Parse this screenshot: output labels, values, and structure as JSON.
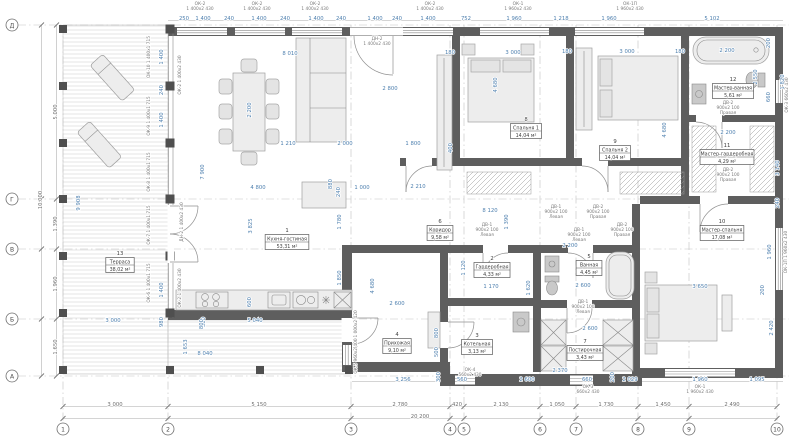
{
  "drawing": {
    "type": "architectural-floor-plan",
    "units": "mm",
    "accent_dim_color": "#4d7fae",
    "wall_color": "#5e5e5e",
    "grid": {
      "cols": [
        {
          "label": "1",
          "x": 63
        },
        {
          "label": "2",
          "x": 168
        },
        {
          "label": "3",
          "x": 351
        },
        {
          "label": "4",
          "x": 450
        },
        {
          "label": "5",
          "x": 464
        },
        {
          "label": "6",
          "x": 540
        },
        {
          "label": "7",
          "x": 576
        },
        {
          "label": "8",
          "x": 638
        },
        {
          "label": "9",
          "x": 689
        },
        {
          "label": "10",
          "x": 777
        }
      ],
      "rows": [
        {
          "label": "Д",
          "y": 25
        },
        {
          "label": "Г",
          "y": 199
        },
        {
          "label": "В",
          "y": 249
        },
        {
          "label": "Б",
          "y": 319
        },
        {
          "label": "А",
          "y": 376
        }
      ]
    },
    "rooms": [
      {
        "num": "1",
        "name": "Кухня-гостиная",
        "area": "53,31 м²",
        "x": 287,
        "y": 240
      },
      {
        "num": "2",
        "name": "Гардеробная",
        "area": "4,33 м²",
        "x": 492,
        "y": 268
      },
      {
        "num": "3",
        "name": "Котельная",
        "area": "3,13 м²",
        "x": 477,
        "y": 345
      },
      {
        "num": "4",
        "name": "Прихожая",
        "area": "9,10 м²",
        "x": 397,
        "y": 344
      },
      {
        "num": "5",
        "name": "Ванная",
        "area": "4,45 м²",
        "x": 589,
        "y": 266
      },
      {
        "num": "6",
        "name": "Коридор",
        "area": "9,58 м²",
        "x": 440,
        "y": 231
      },
      {
        "num": "7",
        "name": "Постирочная",
        "area": "3,43 м²",
        "x": 585,
        "y": 351
      },
      {
        "num": "8",
        "name": "Спальня 1",
        "area": "14,04 м²",
        "x": 526,
        "y": 129
      },
      {
        "num": "9",
        "name": "Спальня 2",
        "area": "14,04 м²",
        "x": 615,
        "y": 151
      },
      {
        "num": "10",
        "name": "Мастер-спальня",
        "area": "17,08 м²",
        "x": 722,
        "y": 231
      },
      {
        "num": "11",
        "name": "Мастер-гардеробная",
        "area": "4,29 м²",
        "x": 727,
        "y": 155
      },
      {
        "num": "12",
        "name": "Мастер-ванная",
        "area": "5,61 м²",
        "x": 733,
        "y": 89
      },
      {
        "num": "13",
        "name": "Терраса",
        "area": "38,02 м²",
        "x": 120,
        "y": 263
      }
    ],
    "dims": [
      {
        "t": "250",
        "x": 184,
        "y": 20
      },
      {
        "t": "1 400",
        "x": 203,
        "y": 20
      },
      {
        "t": "240",
        "x": 229,
        "y": 20
      },
      {
        "t": "1 400",
        "x": 259,
        "y": 20
      },
      {
        "t": "240",
        "x": 285,
        "y": 20
      },
      {
        "t": "1 400",
        "x": 316,
        "y": 20
      },
      {
        "t": "240",
        "x": 341,
        "y": 20
      },
      {
        "t": "1 400",
        "x": 375,
        "y": 20
      },
      {
        "t": "240",
        "x": 397,
        "y": 20
      },
      {
        "t": "1 400",
        "x": 428,
        "y": 20
      },
      {
        "t": "752",
        "x": 466,
        "y": 20
      },
      {
        "t": "1 960",
        "x": 514,
        "y": 20
      },
      {
        "t": "1 218",
        "x": 561,
        "y": 20
      },
      {
        "t": "1 960",
        "x": 609,
        "y": 20
      },
      {
        "t": "5 102",
        "x": 712,
        "y": 20
      },
      {
        "t": "5 000",
        "x": 57,
        "y": 112,
        "r": 1,
        "c": "g"
      },
      {
        "t": "1 390",
        "x": 57,
        "y": 224,
        "r": 1,
        "c": "g"
      },
      {
        "t": "1 960",
        "x": 57,
        "y": 284,
        "r": 1,
        "c": "g"
      },
      {
        "t": "1 650",
        "x": 57,
        "y": 347,
        "r": 1,
        "c": "g"
      },
      {
        "t": "10 000",
        "x": 42,
        "y": 200,
        "r": 1,
        "c": "g"
      },
      {
        "t": "3 000",
        "x": 115,
        "y": 406,
        "c": "g"
      },
      {
        "t": "5 150",
        "x": 259,
        "y": 406,
        "c": "g"
      },
      {
        "t": "2 780",
        "x": 400,
        "y": 406,
        "c": "g"
      },
      {
        "t": "420",
        "x": 457,
        "y": 406,
        "c": "g"
      },
      {
        "t": "2 130",
        "x": 501,
        "y": 406,
        "c": "g"
      },
      {
        "t": "1 050",
        "x": 557,
        "y": 406,
        "c": "g"
      },
      {
        "t": "1 730",
        "x": 606,
        "y": 406,
        "c": "g"
      },
      {
        "t": "1 450",
        "x": 663,
        "y": 406,
        "c": "g"
      },
      {
        "t": "2 490",
        "x": 732,
        "y": 406,
        "c": "g"
      },
      {
        "t": "20 200",
        "x": 420,
        "y": 418,
        "c": "g"
      },
      {
        "t": "3 256",
        "x": 403,
        "y": 381
      },
      {
        "t": "300",
        "x": 440,
        "y": 377,
        "r": 1
      },
      {
        "t": "560",
        "x": 462,
        "y": 381
      },
      {
        "t": "2 600",
        "x": 527,
        "y": 381
      },
      {
        "t": "2 370",
        "x": 560,
        "y": 372
      },
      {
        "t": "660",
        "x": 587,
        "y": 381
      },
      {
        "t": "2 029",
        "x": 630,
        "y": 381
      },
      {
        "t": "1 960",
        "x": 700,
        "y": 381
      },
      {
        "t": "1 095",
        "x": 757,
        "y": 381
      },
      {
        "t": "200",
        "x": 614,
        "y": 377,
        "r": 1
      },
      {
        "t": "9 908",
        "x": 80,
        "y": 203,
        "r": 1
      },
      {
        "t": "3 000",
        "x": 113,
        "y": 322
      },
      {
        "t": "980",
        "x": 163,
        "y": 322,
        "r": 1
      },
      {
        "t": "300",
        "x": 205,
        "y": 322,
        "r": 1
      },
      {
        "t": "5 040",
        "x": 255,
        "y": 322
      },
      {
        "t": "600",
        "x": 251,
        "y": 302,
        "r": 1
      },
      {
        "t": "8 040",
        "x": 205,
        "y": 355
      },
      {
        "t": "1 653",
        "x": 187,
        "y": 347,
        "r": 1
      },
      {
        "t": "8 010",
        "x": 290,
        "y": 55
      },
      {
        "t": "2 800",
        "x": 390,
        "y": 90
      },
      {
        "t": "2 200",
        "x": 251,
        "y": 110,
        "r": 1
      },
      {
        "t": "1 210",
        "x": 288,
        "y": 145
      },
      {
        "t": "2 000",
        "x": 345,
        "y": 145
      },
      {
        "t": "1 800",
        "x": 413,
        "y": 145
      },
      {
        "t": "7 900",
        "x": 204,
        "y": 172,
        "r": 1
      },
      {
        "t": "4 800",
        "x": 258,
        "y": 189
      },
      {
        "t": "1 000",
        "x": 362,
        "y": 189
      },
      {
        "t": "880",
        "x": 332,
        "y": 184,
        "r": 1
      },
      {
        "t": "240",
        "x": 340,
        "y": 192,
        "r": 1
      },
      {
        "t": "3 825",
        "x": 252,
        "y": 226,
        "r": 1
      },
      {
        "t": "1 780",
        "x": 341,
        "y": 222,
        "r": 1
      },
      {
        "t": "1 850",
        "x": 341,
        "y": 278,
        "r": 1
      },
      {
        "t": "4 680",
        "x": 374,
        "y": 286,
        "r": 1
      },
      {
        "t": "800",
        "x": 203,
        "y": 324,
        "r": 1
      },
      {
        "t": "2 210",
        "x": 418,
        "y": 188
      },
      {
        "t": "1 400",
        "x": 163,
        "y": 57,
        "r": 1
      },
      {
        "t": "240",
        "x": 163,
        "y": 90,
        "r": 1
      },
      {
        "t": "1 400",
        "x": 163,
        "y": 120,
        "r": 1
      },
      {
        "t": "1 400",
        "x": 163,
        "y": 290,
        "r": 1
      },
      {
        "t": "180",
        "x": 450,
        "y": 54
      },
      {
        "t": "3 000",
        "x": 513,
        "y": 54
      },
      {
        "t": "4 680",
        "x": 497,
        "y": 85,
        "r": 1
      },
      {
        "t": "400",
        "x": 452,
        "y": 148,
        "r": 1
      },
      {
        "t": "180",
        "x": 567,
        "y": 53
      },
      {
        "t": "3 000",
        "x": 627,
        "y": 53
      },
      {
        "t": "180",
        "x": 680,
        "y": 53
      },
      {
        "t": "4 680",
        "x": 666,
        "y": 130,
        "r": 1
      },
      {
        "t": "8 120",
        "x": 490,
        "y": 212
      },
      {
        "t": "1 390",
        "x": 508,
        "y": 222,
        "r": 1
      },
      {
        "t": "1 120",
        "x": 465,
        "y": 268,
        "r": 1
      },
      {
        "t": "1 170",
        "x": 491,
        "y": 288
      },
      {
        "t": "1 620",
        "x": 530,
        "y": 288,
        "r": 1
      },
      {
        "t": "2 600",
        "x": 397,
        "y": 305
      },
      {
        "t": "800",
        "x": 438,
        "y": 333,
        "r": 1
      },
      {
        "t": "500",
        "x": 438,
        "y": 352,
        "r": 1
      },
      {
        "t": "2 600",
        "x": 583,
        "y": 287
      },
      {
        "t": "2 600",
        "x": 590,
        "y": 330
      },
      {
        "t": "2 200",
        "x": 570,
        "y": 247
      },
      {
        "t": "2 200",
        "x": 727,
        "y": 52
      },
      {
        "t": "200",
        "x": 770,
        "y": 43,
        "r": 1
      },
      {
        "t": "2 550",
        "x": 757,
        "y": 77,
        "r": 1
      },
      {
        "t": "660",
        "x": 770,
        "y": 97,
        "r": 1
      },
      {
        "t": "1 820",
        "x": 784,
        "y": 82,
        "r": 1
      },
      {
        "t": "2 200",
        "x": 728,
        "y": 134
      },
      {
        "t": "1 950",
        "x": 751,
        "y": 157,
        "r": 1
      },
      {
        "t": "3 140",
        "x": 779,
        "y": 168,
        "r": 1
      },
      {
        "t": "240",
        "x": 779,
        "y": 203,
        "r": 1
      },
      {
        "t": "1 960",
        "x": 771,
        "y": 252,
        "r": 1
      },
      {
        "t": "3 650",
        "x": 700,
        "y": 288
      },
      {
        "t": "200",
        "x": 764,
        "y": 290,
        "r": 1
      },
      {
        "t": "2 420",
        "x": 773,
        "y": 328,
        "r": 1
      }
    ],
    "tags": [
      {
        "x": 200,
        "y": 5,
        "lines": [
          "ОК-2",
          "1 400х2 430"
        ]
      },
      {
        "x": 257,
        "y": 5,
        "lines": [
          "ОК-2",
          "1 400х2 430"
        ]
      },
      {
        "x": 315,
        "y": 5,
        "lines": [
          "ОК-2",
          "1 400х2 430"
        ]
      },
      {
        "x": 430,
        "y": 5,
        "lines": [
          "ОК-2",
          "1 400х2 430"
        ]
      },
      {
        "x": 518,
        "y": 5,
        "lines": [
          "ОК-1",
          "1 960х2 430"
        ]
      },
      {
        "x": 630,
        "y": 5,
        "lines": [
          "ОК-1П",
          "1 960х2 430"
        ]
      },
      {
        "x": 377,
        "y": 40,
        "lines": [
          "ДН-2",
          "1 400х2 430"
        ]
      },
      {
        "x": 487,
        "y": 226,
        "lines": [
          "ДВ-1",
          "900х2 100",
          "Левая"
        ]
      },
      {
        "x": 556,
        "y": 208,
        "lines": [
          "ДВ-1",
          "900х2 100",
          "Левая"
        ]
      },
      {
        "x": 598,
        "y": 208,
        "lines": [
          "ДВ-2",
          "900х2 100",
          "Правая"
        ]
      },
      {
        "x": 579,
        "y": 231,
        "lines": [
          "ДВ-1",
          "900х2 100",
          "Левая"
        ]
      },
      {
        "x": 622,
        "y": 226,
        "lines": [
          "ДВ-2",
          "900х2 100",
          "Правая"
        ]
      },
      {
        "x": 583,
        "y": 303,
        "lines": [
          "ДВ-1",
          "900х2 100",
          "Левая"
        ]
      },
      {
        "x": 728,
        "y": 104,
        "lines": [
          "ДВ-2",
          "900х2 100",
          "Правая"
        ]
      },
      {
        "x": 728,
        "y": 171,
        "lines": [
          "ДВ-2",
          "900х2 100",
          "Правая"
        ]
      },
      {
        "x": 588,
        "y": 388,
        "lines": [
          "ОК-3",
          "660х2 430"
        ]
      },
      {
        "x": 700,
        "y": 388,
        "lines": [
          "ОК-1",
          "1 960х2 430"
        ]
      },
      {
        "x": 470,
        "y": 371,
        "lines": [
          "ОК-4",
          "560х2 430"
        ]
      },
      {
        "x": 357,
        "y": 330,
        "lines": [
          "ДН-1 1 000х2 420"
        ],
        "r": 1
      },
      {
        "x": 357,
        "y": 356,
        "lines": [
          "ОК-5 960х2 400"
        ],
        "r": 1
      },
      {
        "x": 183,
        "y": 222,
        "lines": [
          "ДН-2 1 400х2 430"
        ],
        "r": 1
      },
      {
        "x": 181,
        "y": 75,
        "lines": [
          "ОК-2 1 400х2 430"
        ],
        "r": 1
      },
      {
        "x": 181,
        "y": 288,
        "lines": [
          "ОК-2 1 400х2 430"
        ],
        "r": 1
      },
      {
        "x": 150,
        "y": 57,
        "lines": [
          "ОК-10 1 400х1 715"
        ],
        "r": 1
      },
      {
        "x": 150,
        "y": 116,
        "lines": [
          "ОК-9 1 400х1 715"
        ],
        "r": 1
      },
      {
        "x": 150,
        "y": 172,
        "lines": [
          "ОК-8 1 400х1 715"
        ],
        "r": 1
      },
      {
        "x": 150,
        "y": 225,
        "lines": [
          "ОК-7 1 400х1 715"
        ],
        "r": 1
      },
      {
        "x": 150,
        "y": 283,
        "lines": [
          "ОК-6 1 400х1 715"
        ],
        "r": 1
      },
      {
        "x": 788,
        "y": 95,
        "lines": [
          "ОК-3 660х2 430"
        ],
        "r": 1
      },
      {
        "x": 787,
        "y": 252,
        "lines": [
          "ОК-1П 1 960х2 430"
        ],
        "r": 1
      }
    ]
  }
}
